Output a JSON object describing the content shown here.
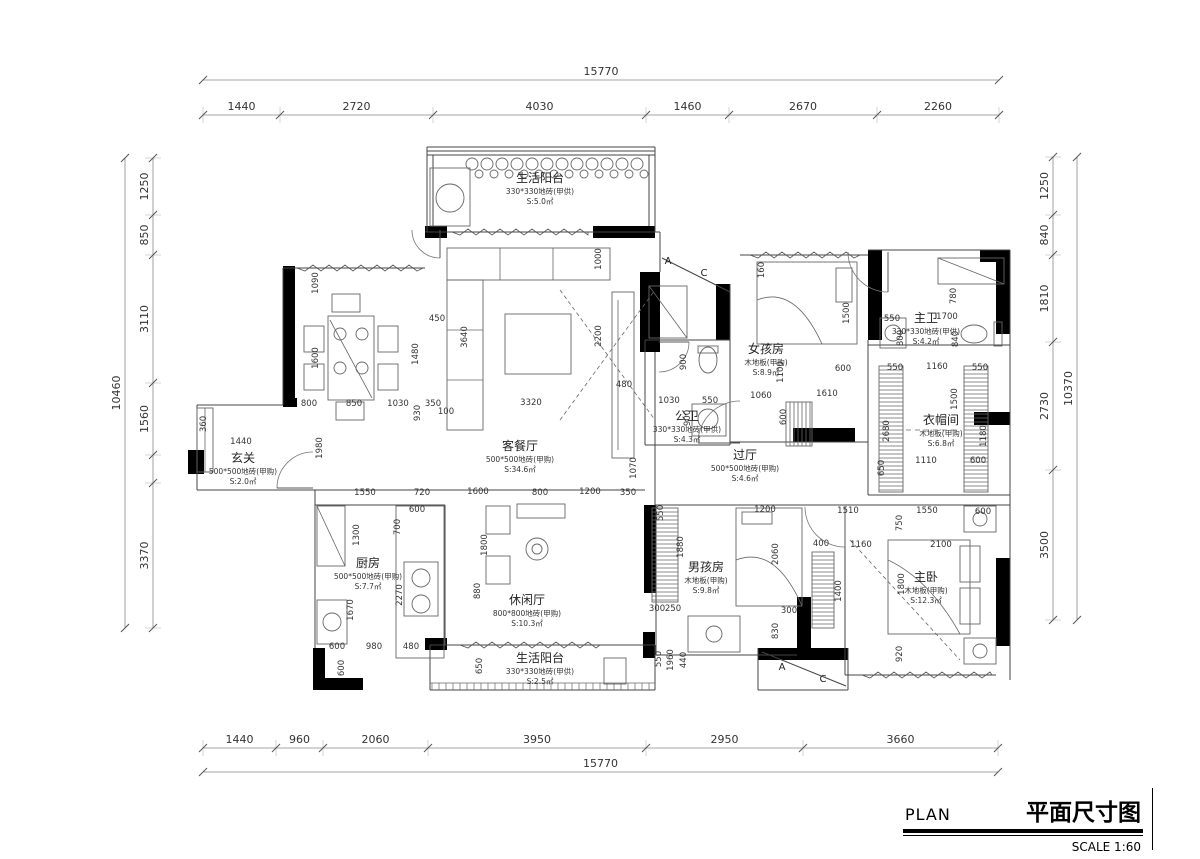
{
  "title_block": {
    "plan_label": "PLAN",
    "title": "平面尺寸图",
    "scale_label": "SCALE 1:60"
  },
  "dims": {
    "top": {
      "total": "15770",
      "segments": [
        "1440",
        "2720",
        "4030",
        "1460",
        "2670",
        "2260"
      ]
    },
    "bottom": {
      "total": "15770",
      "segments": [
        "1440",
        "960",
        "2060",
        "3950",
        "2950",
        "3660"
      ]
    },
    "left": {
      "total": "10460",
      "segments": [
        "1250",
        "850",
        "3110",
        "1560",
        "3370"
      ]
    },
    "right": {
      "total": "10370",
      "segments": [
        "1250",
        "840",
        "1810",
        "2730",
        "3500"
      ]
    }
  },
  "rooms": [
    {
      "name": "生活阳台",
      "spec": "330*330地砖(甲供)",
      "area": "S:5.0㎡",
      "x": 540,
      "y": 182
    },
    {
      "name": "客餐厅",
      "spec": "500*500地砖(甲购)",
      "area": "S:34.6㎡",
      "x": 520,
      "y": 450
    },
    {
      "name": "玄关",
      "spec": "500*500地砖(甲购)",
      "area": "S:2.0㎡",
      "x": 243,
      "y": 462
    },
    {
      "name": "厨房",
      "spec": "500*500地砖(甲购)",
      "area": "S:7.7㎡",
      "x": 368,
      "y": 567
    },
    {
      "name": "休闲厅",
      "spec": "800*800地砖(甲购)",
      "area": "S:10.3㎡",
      "x": 527,
      "y": 604
    },
    {
      "name": "公卫",
      "spec": "330*330地砖(甲供)",
      "area": "S:4.3㎡",
      "x": 687,
      "y": 420
    },
    {
      "name": "女孩房",
      "spec": "木地板(甲购)",
      "area": "S:8.9㎡",
      "x": 766,
      "y": 353
    },
    {
      "name": "过厅",
      "spec": "500*500地砖(甲购)",
      "area": "S:4.6㎡",
      "x": 745,
      "y": 459
    },
    {
      "name": "主卫",
      "spec": "330*330地砖(甲供)",
      "area": "S:4.2㎡",
      "x": 926,
      "y": 322
    },
    {
      "name": "衣帽间",
      "spec": "木地板(甲购)",
      "area": "S:6.8㎡",
      "x": 941,
      "y": 424
    },
    {
      "name": "男孩房",
      "spec": "木地板(甲购)",
      "area": "S:9.8㎡",
      "x": 706,
      "y": 571
    },
    {
      "name": "主卧",
      "spec": "木地板(甲购)",
      "area": "S:12.3㎡",
      "x": 926,
      "y": 581
    },
    {
      "name": "生活阳台",
      "spec": "330*330地砖(甲供)",
      "area": "S:2.5㎡",
      "x": 540,
      "y": 662
    }
  ],
  "interior_dims": [
    {
      "t": "1090",
      "x": 318,
      "y": 283,
      "r": 1
    },
    {
      "t": "1600",
      "x": 318,
      "y": 358,
      "r": 1
    },
    {
      "t": "800",
      "x": 309,
      "y": 406
    },
    {
      "t": "850",
      "x": 354,
      "y": 406
    },
    {
      "t": "1030",
      "x": 398,
      "y": 406
    },
    {
      "t": "930",
      "x": 420,
      "y": 413,
      "r": 1
    },
    {
      "t": "350",
      "x": 433,
      "y": 406
    },
    {
      "t": "100",
      "x": 446,
      "y": 414
    },
    {
      "t": "450",
      "x": 437,
      "y": 321
    },
    {
      "t": "1480",
      "x": 418,
      "y": 354,
      "r": 1
    },
    {
      "t": "3640",
      "x": 467,
      "y": 337,
      "r": 1
    },
    {
      "t": "1000",
      "x": 601,
      "y": 259,
      "r": 1
    },
    {
      "t": "2200",
      "x": 601,
      "y": 336,
      "r": 1
    },
    {
      "t": "480",
      "x": 624,
      "y": 387
    },
    {
      "t": "3320",
      "x": 531,
      "y": 405
    },
    {
      "t": "1070",
      "x": 636,
      "y": 468,
      "r": 1
    },
    {
      "t": "900",
      "x": 686,
      "y": 362,
      "r": 1
    },
    {
      "t": "1030",
      "x": 669,
      "y": 403
    },
    {
      "t": "550",
      "x": 710,
      "y": 403
    },
    {
      "t": "900",
      "x": 690,
      "y": 418,
      "r": 1
    },
    {
      "t": "1060",
      "x": 761,
      "y": 398
    },
    {
      "t": "1100",
      "x": 783,
      "y": 372,
      "r": 1
    },
    {
      "t": "600",
      "x": 786,
      "y": 417,
      "r": 1
    },
    {
      "t": "1500",
      "x": 849,
      "y": 313,
      "r": 1
    },
    {
      "t": "1610",
      "x": 827,
      "y": 396
    },
    {
      "t": "600",
      "x": 843,
      "y": 371
    },
    {
      "t": "160",
      "x": 764,
      "y": 270,
      "r": 1
    },
    {
      "t": "550",
      "x": 892,
      "y": 321
    },
    {
      "t": "1700",
      "x": 947,
      "y": 319
    },
    {
      "t": "800",
      "x": 903,
      "y": 338,
      "r": 1
    },
    {
      "t": "840",
      "x": 958,
      "y": 339,
      "r": 1
    },
    {
      "t": "780",
      "x": 956,
      "y": 296,
      "r": 1
    },
    {
      "t": "550",
      "x": 895,
      "y": 370
    },
    {
      "t": "1160",
      "x": 937,
      "y": 369
    },
    {
      "t": "550",
      "x": 980,
      "y": 370
    },
    {
      "t": "1500",
      "x": 957,
      "y": 399,
      "r": 1
    },
    {
      "t": "2680",
      "x": 889,
      "y": 431,
      "r": 1
    },
    {
      "t": "1180",
      "x": 986,
      "y": 436,
      "r": 1
    },
    {
      "t": "650",
      "x": 884,
      "y": 468,
      "r": 1
    },
    {
      "t": "1110",
      "x": 926,
      "y": 463
    },
    {
      "t": "600",
      "x": 978,
      "y": 463
    },
    {
      "t": "1550",
      "x": 365,
      "y": 495
    },
    {
      "t": "720",
      "x": 422,
      "y": 495
    },
    {
      "t": "1600",
      "x": 478,
      "y": 494
    },
    {
      "t": "800",
      "x": 540,
      "y": 495
    },
    {
      "t": "1200",
      "x": 590,
      "y": 494
    },
    {
      "t": "350",
      "x": 628,
      "y": 495
    },
    {
      "t": "550",
      "x": 663,
      "y": 513,
      "r": 1
    },
    {
      "t": "1200",
      "x": 765,
      "y": 512
    },
    {
      "t": "1510",
      "x": 848,
      "y": 513
    },
    {
      "t": "1550",
      "x": 927,
      "y": 513
    },
    {
      "t": "600",
      "x": 983,
      "y": 514
    },
    {
      "t": "600",
      "x": 417,
      "y": 512
    },
    {
      "t": "700",
      "x": 400,
      "y": 527,
      "r": 1
    },
    {
      "t": "1300",
      "x": 359,
      "y": 535,
      "r": 1
    },
    {
      "t": "1800",
      "x": 487,
      "y": 545,
      "r": 1
    },
    {
      "t": "880",
      "x": 480,
      "y": 591,
      "r": 1
    },
    {
      "t": "1670",
      "x": 353,
      "y": 610,
      "r": 1
    },
    {
      "t": "2270",
      "x": 402,
      "y": 595,
      "r": 1
    },
    {
      "t": "1880",
      "x": 683,
      "y": 547,
      "r": 1
    },
    {
      "t": "2060",
      "x": 778,
      "y": 554,
      "r": 1
    },
    {
      "t": "400",
      "x": 821,
      "y": 546
    },
    {
      "t": "1160",
      "x": 861,
      "y": 547
    },
    {
      "t": "2100",
      "x": 941,
      "y": 547
    },
    {
      "t": "750",
      "x": 902,
      "y": 523,
      "r": 1
    },
    {
      "t": "1400",
      "x": 841,
      "y": 591,
      "r": 1
    },
    {
      "t": "1800",
      "x": 904,
      "y": 584,
      "r": 1
    },
    {
      "t": "920",
      "x": 902,
      "y": 654,
      "r": 1
    },
    {
      "t": "830",
      "x": 778,
      "y": 631,
      "r": 1
    },
    {
      "t": "300",
      "x": 789,
      "y": 613
    },
    {
      "t": "300",
      "x": 657,
      "y": 611
    },
    {
      "t": "250",
      "x": 673,
      "y": 611
    },
    {
      "t": "600",
      "x": 337,
      "y": 649
    },
    {
      "t": "980",
      "x": 374,
      "y": 649
    },
    {
      "t": "480",
      "x": 411,
      "y": 649
    },
    {
      "t": "600",
      "x": 344,
      "y": 668,
      "r": 1
    },
    {
      "t": "650",
      "x": 482,
      "y": 666,
      "r": 1
    },
    {
      "t": "550",
      "x": 661,
      "y": 659,
      "r": 1
    },
    {
      "t": "1960",
      "x": 673,
      "y": 660,
      "r": 1
    },
    {
      "t": "440",
      "x": 686,
      "y": 660,
      "r": 1
    },
    {
      "t": "1440",
      "x": 241,
      "y": 444
    },
    {
      "t": "1980",
      "x": 322,
      "y": 448,
      "r": 1
    },
    {
      "t": "360",
      "x": 206,
      "y": 424,
      "r": 1
    }
  ],
  "section_marks": [
    {
      "label": "A",
      "x": 668,
      "y": 264
    },
    {
      "label": "C",
      "x": 704,
      "y": 276
    },
    {
      "label": "A",
      "x": 782,
      "y": 670
    },
    {
      "label": "C",
      "x": 823,
      "y": 682
    }
  ]
}
